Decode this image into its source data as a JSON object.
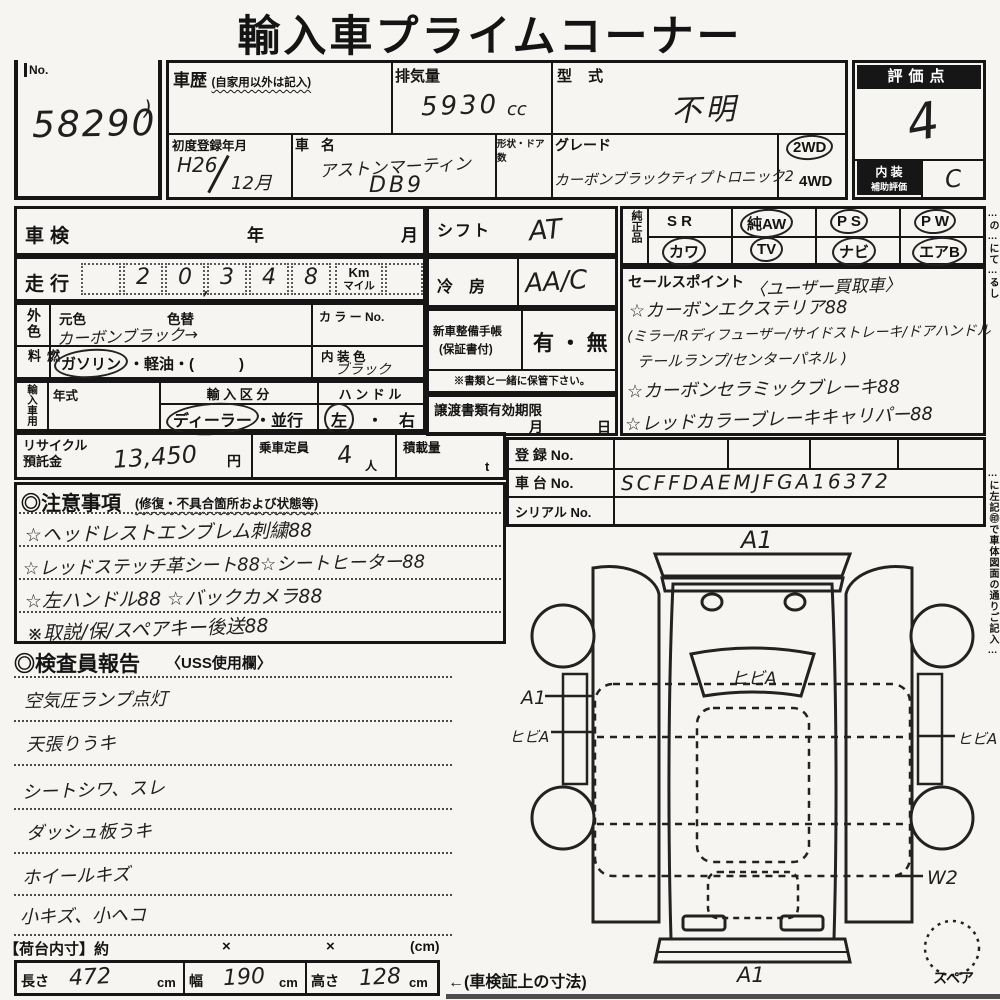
{
  "title": "輸入車プライムコーナー",
  "no_box": {
    "label": "No.",
    "value": "58290",
    "suffix": ")"
  },
  "header": {
    "history": {
      "label": "車歴",
      "note": "(自家用以外は記入)"
    },
    "displacement": {
      "label": "排気量",
      "value": "5930",
      "unit": "cc"
    },
    "model_code": {
      "label": "型 式",
      "value": "不明"
    },
    "first_reg": {
      "label": "初度登録年月",
      "value": "H26",
      "month": "12月"
    },
    "car_name": {
      "label": "車 名",
      "value": "アストンマーティン",
      "value2": "DB9"
    },
    "shape_doors": {
      "label": "形状・ドア数"
    },
    "grade": {
      "label": "グレード",
      "value": "カーボンブラックティプトロニック2"
    },
    "drive": {
      "opt1": "2WD",
      "opt2": "4WD",
      "selected": "2WD"
    }
  },
  "score": {
    "label": "評価点",
    "value": "4",
    "interior_label": "内 装",
    "interior_sub": "補助評価",
    "interior_value": "C"
  },
  "left": {
    "shaken": {
      "label": "車検",
      "year": "年",
      "month": "月"
    },
    "mileage": {
      "label": "走行",
      "digits": [
        "",
        "2",
        "0",
        "3",
        "4",
        "8"
      ],
      "comma": ",",
      "unit_km": "Km",
      "unit_mile": "マイル"
    },
    "color": {
      "group": "外色",
      "label1": "元色",
      "label2": "色替",
      "value": "カーボンブラック→",
      "colorno_label": "カ ラ ー No."
    },
    "fuel": {
      "group": "燃料",
      "opt1": "ガソリン",
      "rest": "・軽油・(　　　)",
      "interior_label": "内 装 色",
      "interior_value": "ブラック"
    },
    "import": {
      "group": "輸入車用",
      "year_label": "年式",
      "division_label": "輸 入 区 分",
      "division_opt1": "ディーラー",
      "division_rest": "・並行",
      "handle_label": "ハ ン ド ル",
      "handle_l": "左",
      "handle_dot": "・",
      "handle_r": "右"
    },
    "recycle": {
      "label1": "リサイクル",
      "label2": "預託金",
      "value": "13,450",
      "unit": "円",
      "capacity_label": "乗車定員",
      "capacity_value": "4",
      "capacity_unit": "人",
      "load_label": "積載量",
      "load_unit": "t"
    }
  },
  "caution": {
    "title": "◎注意事項",
    "subtitle": "(修復・不具合箇所および状態等)",
    "lines": [
      "☆ヘッドレストエンブレム刺繍88",
      "☆レッドステッチ革シート88☆シートヒーター88",
      "☆左ハンドル88 ☆バックカメラ88",
      "※取説/保/スペアキー後送88"
    ]
  },
  "inspector": {
    "title": "◎検査員報告",
    "subtitle": "〈USS使用欄〉",
    "lines": [
      "空気圧ランプ点灯",
      "天張りうキ",
      "シートシワ、スレ",
      "ダッシュ板うキ",
      "ホイールキズ",
      "小キズ、小ヘコ"
    ]
  },
  "cargo": {
    "label": "【荷台内寸】約",
    "x1": "×",
    "x2": "×",
    "unit": "(cm)"
  },
  "dims": {
    "length_label": "長さ",
    "length_value": "472",
    "length_unit": "cm",
    "width_label": "幅",
    "width_value": "190",
    "width_unit": "cm",
    "height_label": "高さ",
    "height_value": "128",
    "height_unit": "cm",
    "note": "←(車検証上の寸法)"
  },
  "mid": {
    "shift": {
      "label": "シフト",
      "value": "AT"
    },
    "ac": {
      "label": "冷　房",
      "value": "AA/C"
    },
    "book": {
      "label1": "新車整備手帳",
      "label2": "(保証書付)",
      "value": "有 ・ 無"
    },
    "book_note": "※書類と一緒に保管下さい。",
    "transfer": {
      "label": "譲渡書類有効期限",
      "month": "月",
      "day": "日"
    }
  },
  "equip": {
    "group": "純正品",
    "row1": [
      "S R",
      "純AW",
      "P S",
      "P W"
    ],
    "row2": [
      "カワ",
      "TV",
      "ナビ",
      "エアB"
    ]
  },
  "sales": {
    "label": "セールスポイント",
    "note": "〈ユーザー買取車〉",
    "lines": [
      "☆カーボンエクステリア88",
      "(ミラー/Rディフューザー/サイドストレーキ/ドアハンドル",
      "テールランプ/センターパネル )",
      "☆カーボンセラミックブレーキ88",
      "☆レッドカラーブレーキキャリパー88"
    ]
  },
  "ids": {
    "reg_label": "登 録 No.",
    "chassis_label": "車 台 No.",
    "chassis_value": "SCFFDAEMJFGA16372",
    "serial_label": "シリアル No."
  },
  "diagram": {
    "front": "A1",
    "rear": "A1",
    "windshield": "ヒビA",
    "left_a1": "A1",
    "left_mark": "ヒビA",
    "right_mark": "ヒビA",
    "w2": "W2",
    "spare": "スペア"
  },
  "edge_notes": {
    "top": "…の…にて…るし",
    "bottom": "…に左記㊞で車体図面の通りご記入…"
  }
}
